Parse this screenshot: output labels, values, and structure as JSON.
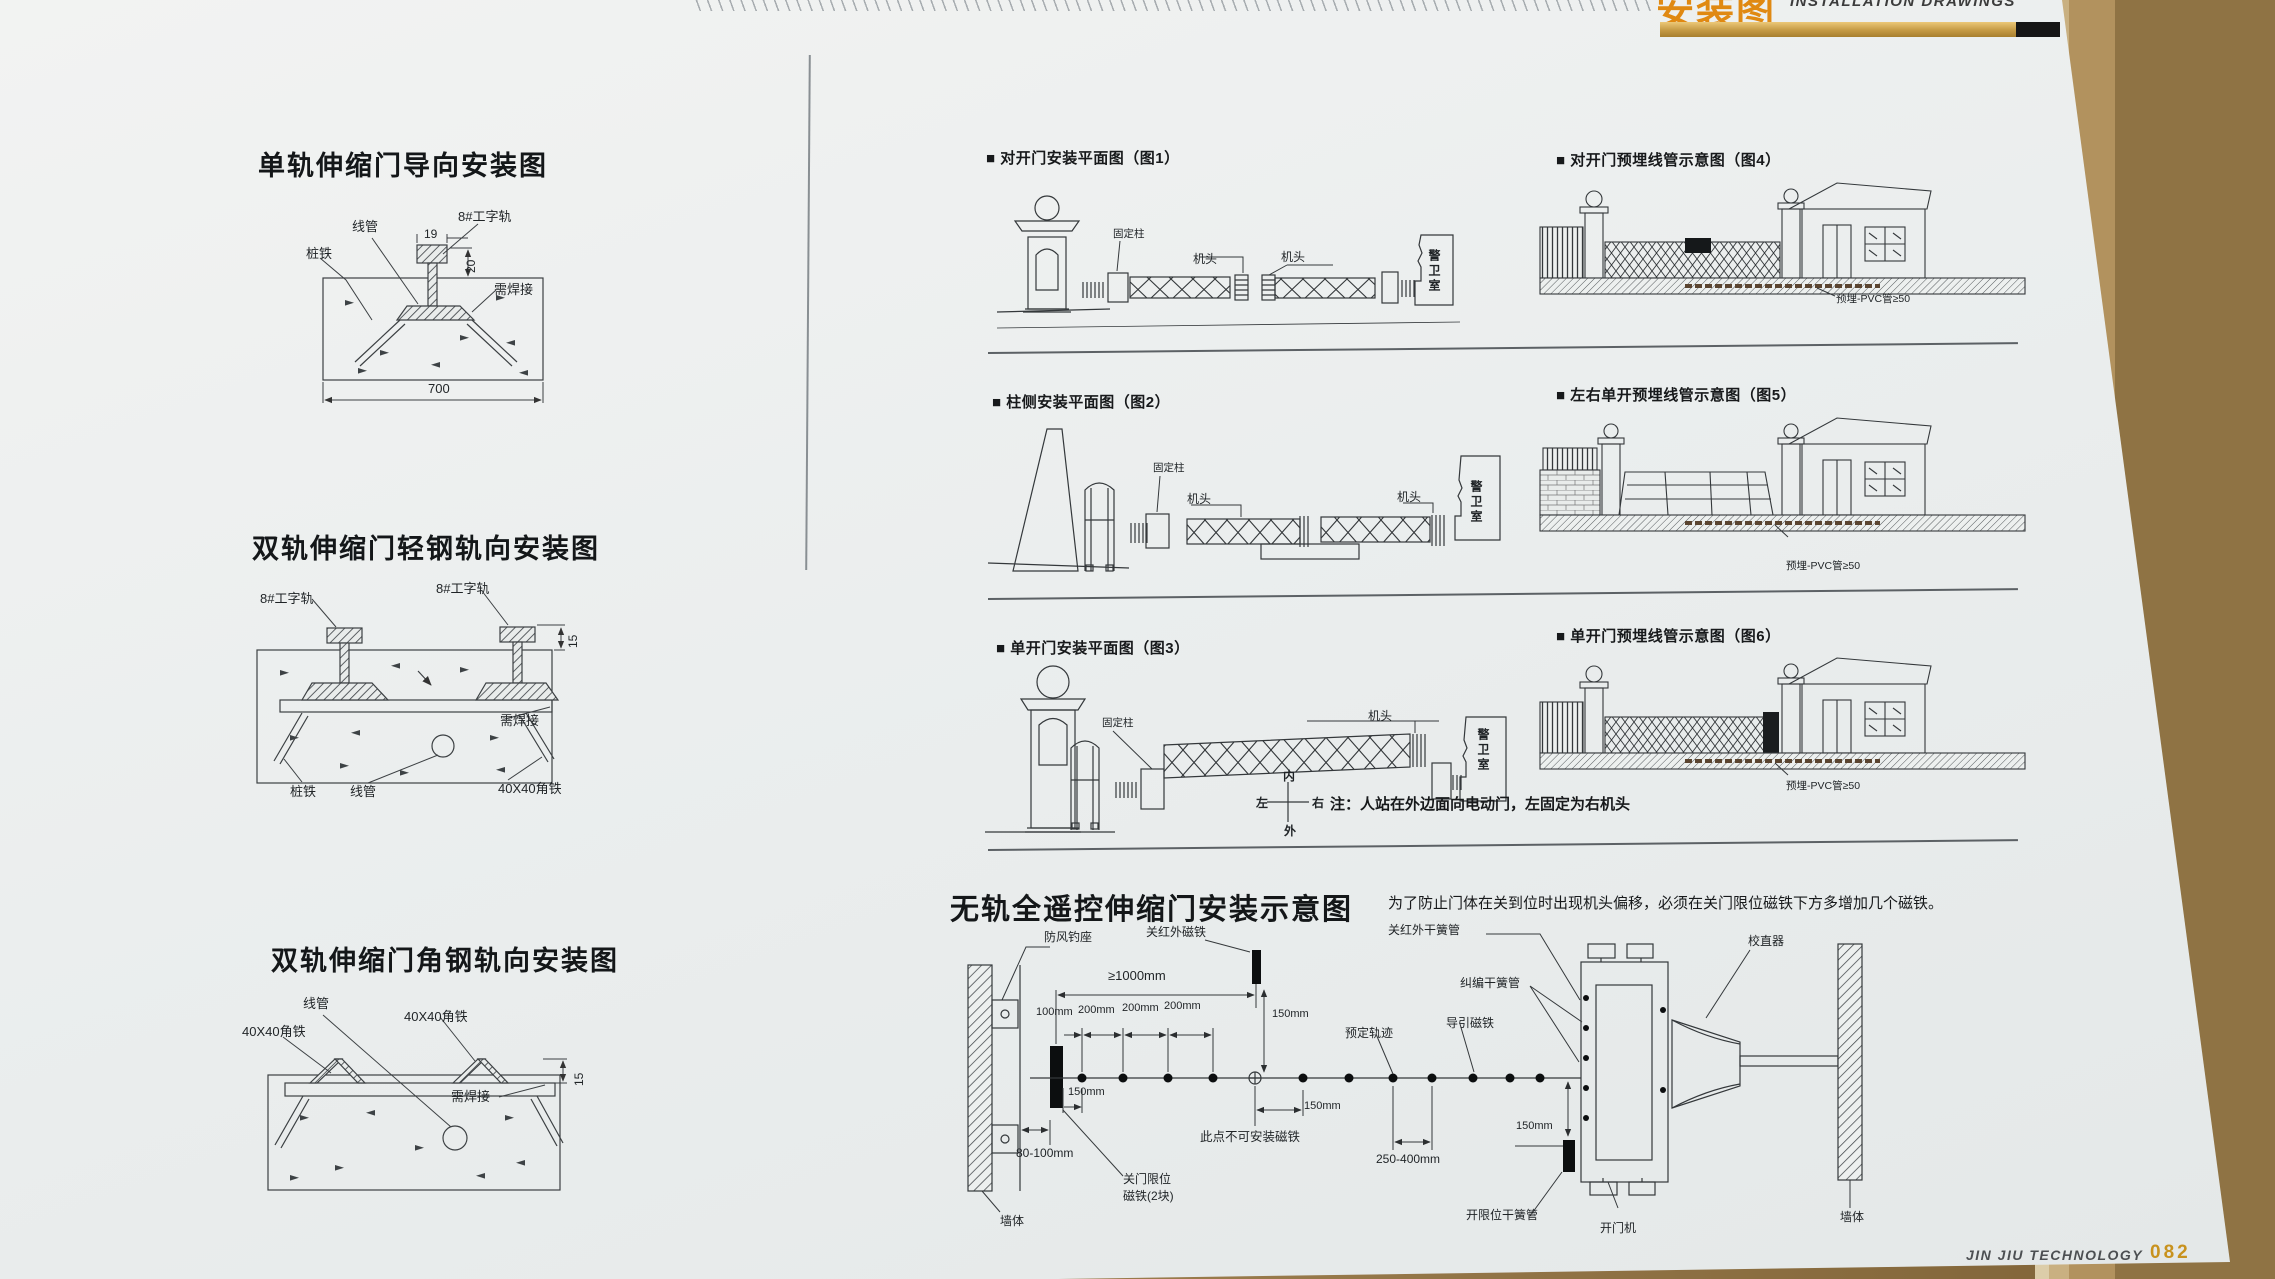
{
  "header": {
    "title_cn": "安装图",
    "title_en": "INSTALLATION DRAWINGS"
  },
  "footer": {
    "brand": "JIN JIU TECHNOLOGY",
    "page_no": "082"
  },
  "colors": {
    "accent_gold": "#c8921e",
    "title_orange": "#e08912",
    "paper": "#edf0ef",
    "ink": "#222222"
  },
  "left": {
    "d1": {
      "title": "单轨伸缩门导向安装图",
      "conduit": "线管",
      "rail": "8#工字轨",
      "stake": "桩铁",
      "weld": "需焊接",
      "d19": "19",
      "d20": "20",
      "d700": "700"
    },
    "d2": {
      "title": "双轨伸缩门轻钢轨向安装图",
      "rail_left": "8#工字轨",
      "rail_right": "8#工字轨",
      "d15": "15",
      "weld": "需焊接",
      "stake": "桩铁",
      "conduit": "线管",
      "angle": "40X40角铁"
    },
    "d3": {
      "title": "双轨伸缩门角钢轨向安装图",
      "conduit": "线管",
      "angle_left": "40X40角铁",
      "angle_right": "40X40角铁",
      "d15": "15",
      "weld": "需焊接"
    }
  },
  "right": {
    "fig1": {
      "title": "■ 对开门安装平面图（图1）",
      "fixed_post": "固定柱",
      "head_left": "机头",
      "head_right": "机头",
      "guard_room": "警卫室"
    },
    "fig2": {
      "title": "■ 柱侧安装平面图（图2）",
      "fixed_post": "固定柱",
      "head_left": "机头",
      "head_right": "机头",
      "guard_room": "警卫室"
    },
    "fig3": {
      "title": "■ 单开门安装平面图（图3）",
      "fixed_post": "固定柱",
      "head": "机头",
      "guard_room": "警卫室",
      "compass": {
        "inner": "内",
        "outer": "外",
        "left": "左",
        "right": "右"
      },
      "note": "注：人站在外边面向电动门，左固定为右机头"
    },
    "fig4": {
      "title": "■ 对开门预埋线管示意图（图4）",
      "pvc": "预埋-PVC管≥50"
    },
    "fig5": {
      "title": "■ 左右单开预埋线管示意图（图5）",
      "pvc": "预埋-PVC管≥50"
    },
    "fig6": {
      "title": "■ 单开门预埋线管示意图（图6）",
      "pvc": "预埋-PVC管≥50"
    }
  },
  "trackless": {
    "title": "无轨全遥控伸缩门安装示意图",
    "note": "为了防止门体在关到位时出现机头偏移，必须在关门限位磁铁下方多增加几个磁铁。",
    "labels": {
      "wind_hook": "防风钓座",
      "close_ir_magnet": "关红外磁铁",
      "close_ir_reed": "关红外干簧管",
      "align_reed": "纠编干簧管",
      "straightener": "校直器",
      "wall_left": "墙体",
      "wall_right": "墙体",
      "track": "预定轨迹",
      "guide_magnet": "导引磁铁",
      "no_magnet_here": "此点不可安装磁铁",
      "close_limit_1": "关门限位",
      "close_limit_2": "磁铁(2块)",
      "open_limit_reed": "开限位干簧管",
      "door_opener": "开门机",
      "d1000": "≥1000mm",
      "d100": "100mm",
      "d200a": "200mm",
      "d200b": "200mm",
      "d200c": "200mm",
      "d150a": "150mm",
      "d150b": "150mm",
      "d150c": "150mm",
      "d150d": "150mm",
      "d250": "250-400mm",
      "d80": "80-100mm"
    }
  }
}
